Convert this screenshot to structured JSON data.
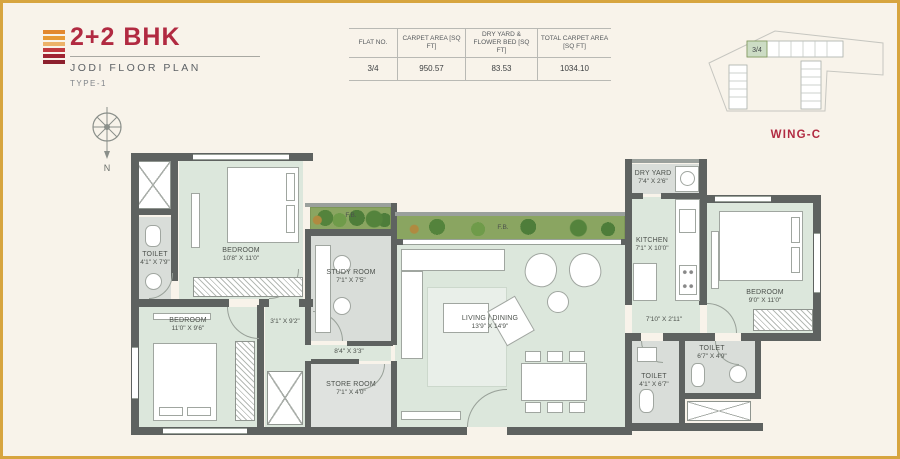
{
  "header": {
    "title": "2+2 BHK",
    "subtitle": "JODI FLOOR PLAN",
    "type_label": "TYPE-1"
  },
  "table": {
    "headers": [
      "FLAT NO.",
      "CARPET AREA [SQ FT]",
      "DRY YARD & FLOWER BED [SQ FT]",
      "TOTAL CARPET AREA [SQ FT]"
    ],
    "row": [
      "3/4",
      "950.57",
      "83.53",
      "1034.10"
    ]
  },
  "wing": {
    "label": "WING-C",
    "highlight_unit": "3/4"
  },
  "compass": {
    "north_label": "N"
  },
  "plan": {
    "rooms": {
      "bedroom1": {
        "name": "BEDROOM",
        "dims": "10'8\" X 11'0\""
      },
      "toilet1": {
        "name": "TOILET",
        "dims": "4'1\" X 7'9\""
      },
      "bedroom2": {
        "name": "BEDROOM",
        "dims": "11'0\" X 9'6\""
      },
      "passage1": {
        "dims": "3'1\" X 9'2\""
      },
      "study": {
        "name": "STUDY ROOM",
        "dims": "7'1\" X 7'5\""
      },
      "passage2": {
        "dims": "8'4\" X 3'3\""
      },
      "store": {
        "name": "STORE ROOM",
        "dims": "7'1\" X 4'0\""
      },
      "living": {
        "name": "LIVING / DINING",
        "dims": "13'9\" X 14'9\""
      },
      "kitchen": {
        "name": "KITCHEN",
        "dims": "7'1\" X 10'0\""
      },
      "dryyard": {
        "name": "DRY YARD",
        "dims": "7'4\" X 2'6\""
      },
      "passage3": {
        "dims": "7'10\" X 2'11\""
      },
      "toilet2": {
        "name": "TOILET",
        "dims": "4'1\" X 6'7\""
      },
      "toilet3": {
        "name": "TOILET",
        "dims": "6'7\" X 4'9\""
      },
      "bedroom3": {
        "name": "BEDROOM",
        "dims": "9'0\" X 11'0\""
      },
      "fb1": {
        "name": "F.B."
      },
      "fb2": {
        "name": "F.B."
      }
    }
  },
  "colors": {
    "accent": "#b12a41",
    "frame": "#d7a53f",
    "wall": "#5e6260",
    "floor_green": "#dce7dc",
    "floor_gray": "#d9ddd9",
    "planting_green": "#8aa561",
    "logo_bars": [
      "#e2882f",
      "#e79a36",
      "#ecb269",
      "#c13a3f",
      "#a02432",
      "#8c1f2d"
    ]
  }
}
